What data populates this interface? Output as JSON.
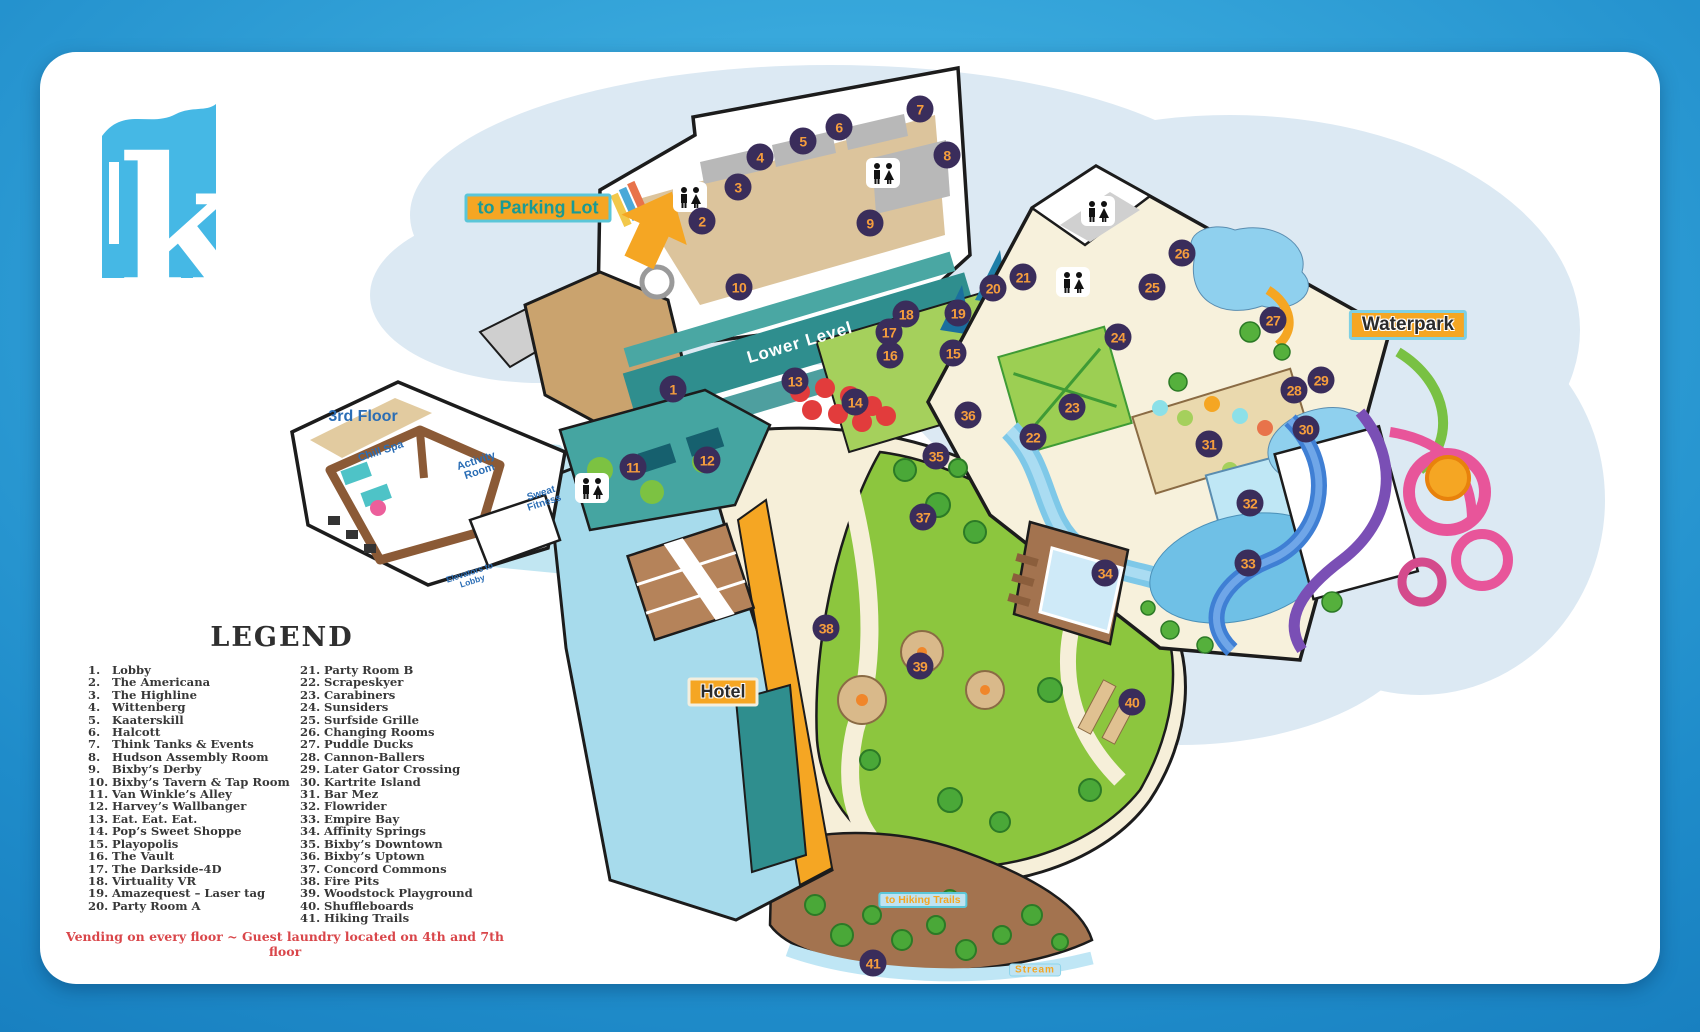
{
  "logo": {
    "letter": "k"
  },
  "labels": {
    "parking": "to Parking Lot",
    "third_floor": "3rd Floor",
    "chill_spa": "Chill Spa",
    "activity_room": "Activity Room",
    "sweat_fitness": "Sweat Fitness",
    "elevators": "Elevators to Lobby",
    "lower_level": "Lower Level",
    "waterpark": "Waterpark",
    "hotel": "Hotel",
    "hiking": "to Hiking Trails",
    "stream": "Stream"
  },
  "legend": {
    "title": "LEGEND",
    "footnote": "Vending on every floor ~ Guest laundry located on 4th and 7th floor",
    "items": [
      {
        "n": "1.",
        "label": "Lobby"
      },
      {
        "n": "2.",
        "label": "The Americana"
      },
      {
        "n": "3.",
        "label": "The Highline"
      },
      {
        "n": "4.",
        "label": "Wittenberg"
      },
      {
        "n": "5.",
        "label": "Kaaterskill"
      },
      {
        "n": "6.",
        "label": "Halcott"
      },
      {
        "n": "7.",
        "label": "Think Tanks & Events"
      },
      {
        "n": "8.",
        "label": "Hudson Assembly Room"
      },
      {
        "n": "9.",
        "label": "Bixby’s Derby"
      },
      {
        "n": "10.",
        "label": "Bixby’s Tavern & Tap Room"
      },
      {
        "n": "11.",
        "label": "Van Winkle’s Alley"
      },
      {
        "n": "12.",
        "label": "Harvey’s Wallbanger"
      },
      {
        "n": "13.",
        "label": "Eat. Eat. Eat."
      },
      {
        "n": "14.",
        "label": "Pop’s Sweet Shoppe"
      },
      {
        "n": "15.",
        "label": "Playopolis"
      },
      {
        "n": "16.",
        "label": "The Vault"
      },
      {
        "n": "17.",
        "label": "The Darkside-4D"
      },
      {
        "n": "18.",
        "label": "Virtuality VR"
      },
      {
        "n": "19.",
        "label": "Amazequest – Laser tag"
      },
      {
        "n": "20.",
        "label": "Party Room A"
      },
      {
        "n": "21.",
        "label": "Party Room B"
      },
      {
        "n": "22.",
        "label": "Scrapeskyer"
      },
      {
        "n": "23.",
        "label": "Carabiners"
      },
      {
        "n": "24.",
        "label": "Sunsiders"
      },
      {
        "n": "25.",
        "label": "Surfside Grille"
      },
      {
        "n": "26.",
        "label": "Changing Rooms"
      },
      {
        "n": "27.",
        "label": "Puddle Ducks"
      },
      {
        "n": "28.",
        "label": "Cannon-Ballers"
      },
      {
        "n": "29.",
        "label": "Later Gator Crossing"
      },
      {
        "n": "30.",
        "label": "Kartrite Island"
      },
      {
        "n": "31.",
        "label": "Bar Mez"
      },
      {
        "n": "32.",
        "label": "Flowrider"
      },
      {
        "n": "33.",
        "label": "Empire Bay"
      },
      {
        "n": "34.",
        "label": "Affinity Springs"
      },
      {
        "n": "35.",
        "label": "Bixby’s Downtown"
      },
      {
        "n": "36.",
        "label": "Bixby’s Uptown"
      },
      {
        "n": "37.",
        "label": "Concord Commons"
      },
      {
        "n": "38.",
        "label": "Fire Pits"
      },
      {
        "n": "39.",
        "label": "Woodstock Playground"
      },
      {
        "n": "40.",
        "label": "Shuffleboards"
      },
      {
        "n": "41.",
        "label": "Hiking Trails"
      }
    ]
  },
  "markers": [
    {
      "n": "1",
      "x": 673,
      "y": 389
    },
    {
      "n": "2",
      "x": 702,
      "y": 221
    },
    {
      "n": "3",
      "x": 738,
      "y": 187
    },
    {
      "n": "4",
      "x": 760,
      "y": 157
    },
    {
      "n": "5",
      "x": 803,
      "y": 141
    },
    {
      "n": "6",
      "x": 839,
      "y": 127
    },
    {
      "n": "7",
      "x": 920,
      "y": 109
    },
    {
      "n": "8",
      "x": 947,
      "y": 155
    },
    {
      "n": "9",
      "x": 870,
      "y": 223
    },
    {
      "n": "10",
      "x": 739,
      "y": 287
    },
    {
      "n": "11",
      "x": 633,
      "y": 467
    },
    {
      "n": "12",
      "x": 707,
      "y": 460
    },
    {
      "n": "13",
      "x": 795,
      "y": 381
    },
    {
      "n": "14",
      "x": 855,
      "y": 402
    },
    {
      "n": "15",
      "x": 953,
      "y": 353
    },
    {
      "n": "16",
      "x": 890,
      "y": 355
    },
    {
      "n": "17",
      "x": 889,
      "y": 332
    },
    {
      "n": "18",
      "x": 906,
      "y": 314
    },
    {
      "n": "19",
      "x": 958,
      "y": 313
    },
    {
      "n": "20",
      "x": 993,
      "y": 288
    },
    {
      "n": "21",
      "x": 1023,
      "y": 277
    },
    {
      "n": "22",
      "x": 1033,
      "y": 437
    },
    {
      "n": "23",
      "x": 1072,
      "y": 407
    },
    {
      "n": "24",
      "x": 1118,
      "y": 337
    },
    {
      "n": "25",
      "x": 1152,
      "y": 287
    },
    {
      "n": "26",
      "x": 1182,
      "y": 253
    },
    {
      "n": "27",
      "x": 1273,
      "y": 320
    },
    {
      "n": "28",
      "x": 1294,
      "y": 390
    },
    {
      "n": "29",
      "x": 1321,
      "y": 380
    },
    {
      "n": "30",
      "x": 1306,
      "y": 429
    },
    {
      "n": "31",
      "x": 1209,
      "y": 444
    },
    {
      "n": "32",
      "x": 1250,
      "y": 503
    },
    {
      "n": "33",
      "x": 1248,
      "y": 563
    },
    {
      "n": "34",
      "x": 1105,
      "y": 573
    },
    {
      "n": "35",
      "x": 936,
      "y": 456
    },
    {
      "n": "36",
      "x": 968,
      "y": 415
    },
    {
      "n": "37",
      "x": 923,
      "y": 517
    },
    {
      "n": "38",
      "x": 826,
      "y": 628
    },
    {
      "n": "39",
      "x": 920,
      "y": 666
    },
    {
      "n": "40",
      "x": 1132,
      "y": 702
    },
    {
      "n": "41",
      "x": 873,
      "y": 963
    }
  ],
  "restrooms": [
    {
      "x": 690,
      "y": 197
    },
    {
      "x": 883,
      "y": 173
    },
    {
      "x": 1098,
      "y": 211
    },
    {
      "x": 1073,
      "y": 282
    },
    {
      "x": 592,
      "y": 488
    }
  ]
}
